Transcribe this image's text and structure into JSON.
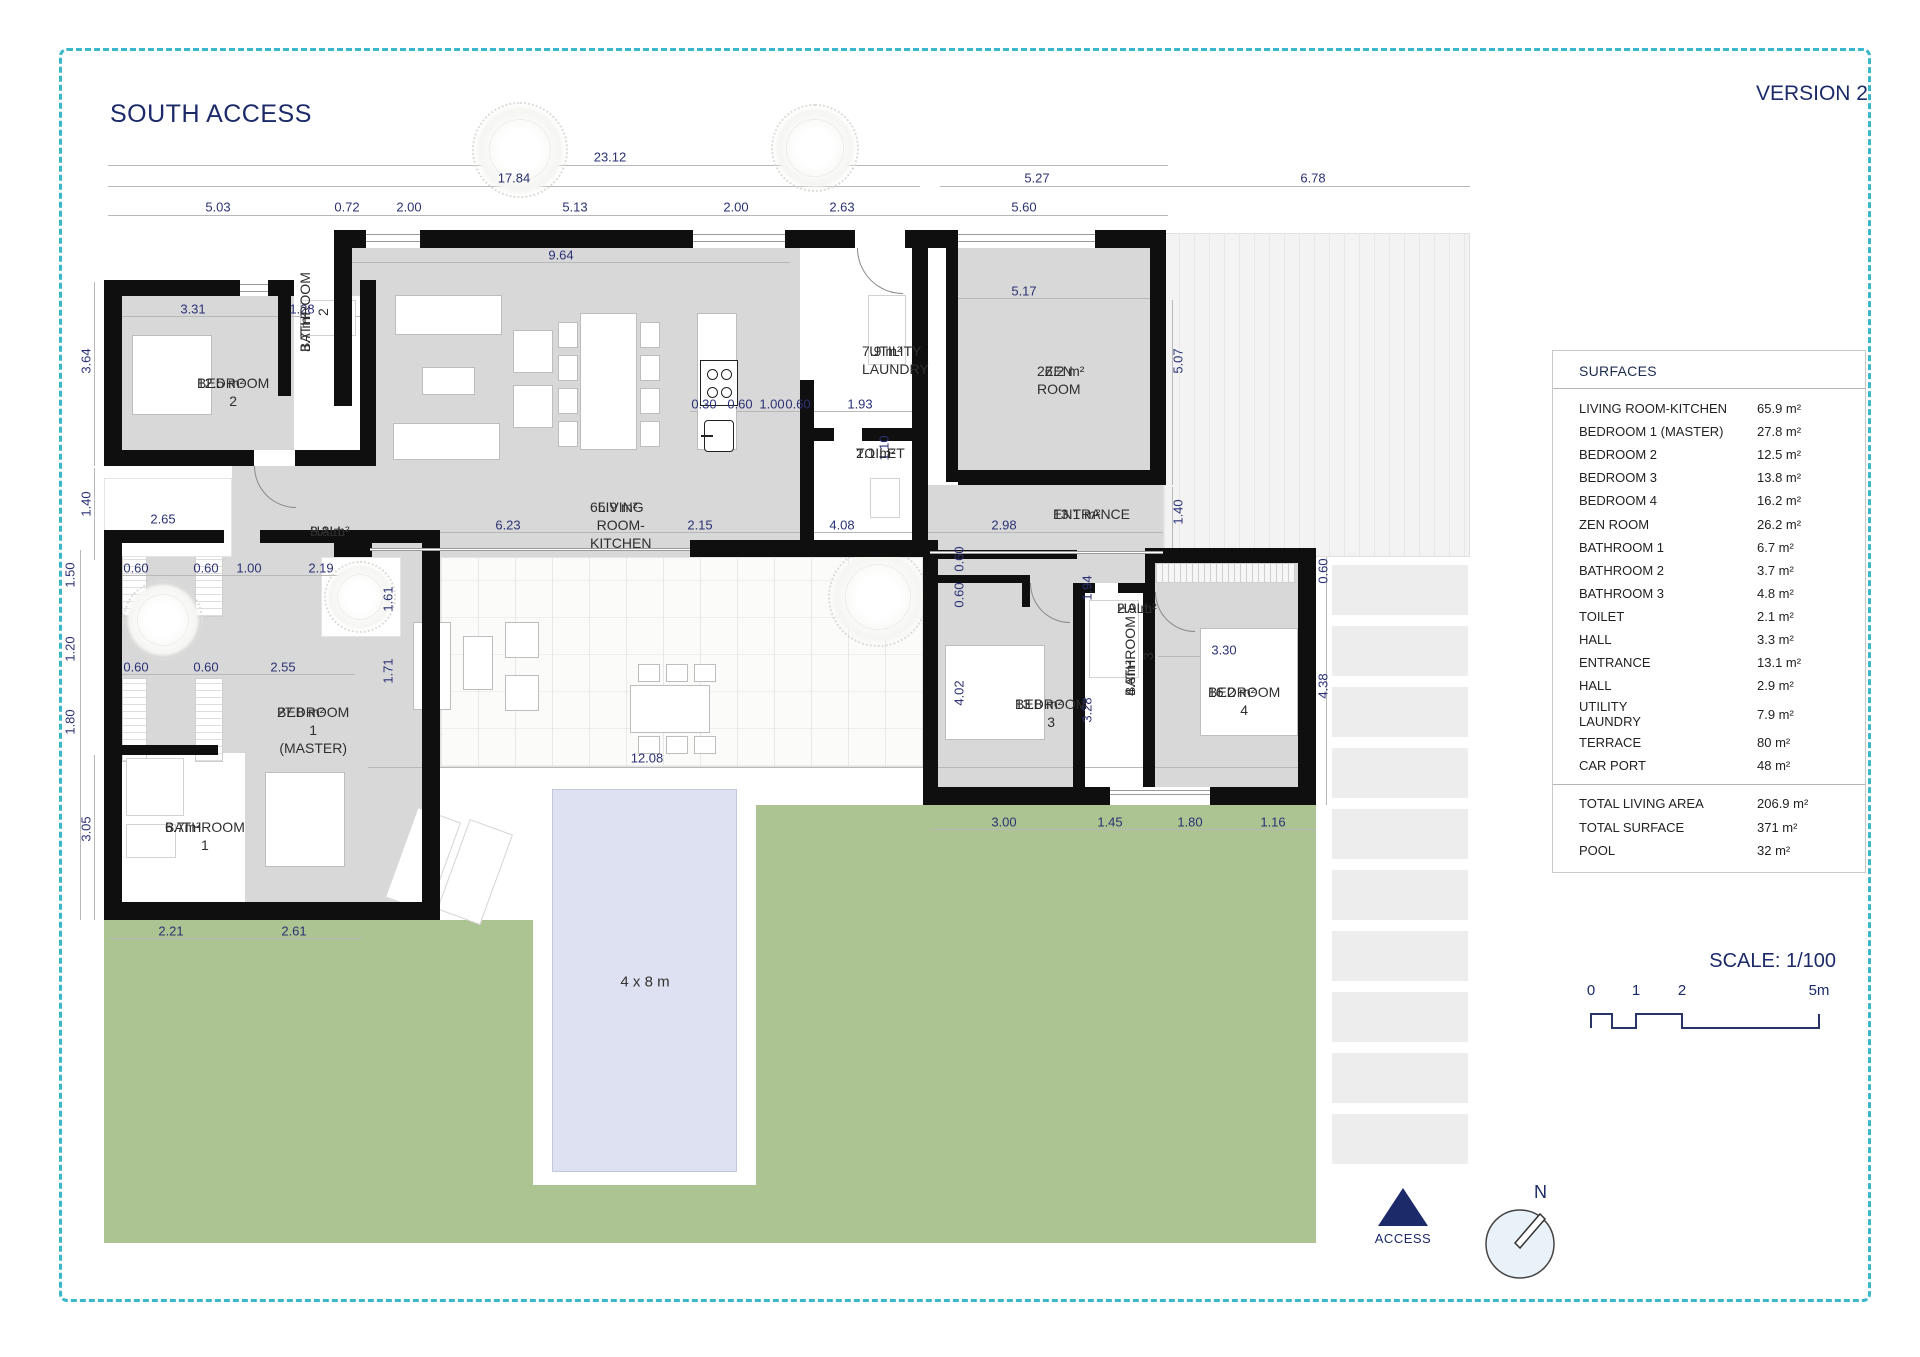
{
  "header": {
    "title": "SOUTH ACCESS",
    "version": "VERSION 2"
  },
  "colors": {
    "accent_navy": "#1c2a6a",
    "border_cyan": "#3ab7ca",
    "grass_green": "#acc392",
    "pool_blue": "#dde1f1",
    "room_gray": "#d8d8d8",
    "wall_black": "#0f0f0f"
  },
  "surfaces_table": {
    "header": "SURFACES",
    "rows": [
      {
        "label": "LIVING ROOM-KITCHEN",
        "value": "65.9 m²"
      },
      {
        "label": "BEDROOM 1 (MASTER)",
        "value": "27.8 m²"
      },
      {
        "label": "BEDROOM 2",
        "value": "12.5 m²"
      },
      {
        "label": "BEDROOM 3",
        "value": "13.8 m²"
      },
      {
        "label": "BEDROOM 4",
        "value": "16.2 m²"
      },
      {
        "label": "ZEN ROOM",
        "value": "26.2 m²"
      },
      {
        "label": "BATHROOM 1",
        "value": "6.7 m²"
      },
      {
        "label": "BATHROOM 2",
        "value": "3.7 m²"
      },
      {
        "label": "BATHROOM 3",
        "value": "4.8 m²"
      },
      {
        "label": "TOILET",
        "value": "2.1 m²"
      },
      {
        "label": "HALL",
        "value": "3.3 m²"
      },
      {
        "label": "ENTRANCE",
        "value": "13.1 m²"
      },
      {
        "label": "HALL",
        "value": "2.9 m²"
      },
      {
        "label": "UTILITY\nLAUNDRY",
        "value": "7.9 m²"
      },
      {
        "label": "TERRACE",
        "value": "80 m²"
      },
      {
        "label": "CAR PORT",
        "value": "48 m²"
      }
    ],
    "totals": [
      {
        "label": "TOTAL LIVING AREA",
        "value": "206.9 m²"
      },
      {
        "label": "TOTAL SURFACE",
        "value": "371 m²"
      },
      {
        "label": "POOL",
        "value": "32 m²"
      }
    ]
  },
  "scale": {
    "label": "SCALE: 1/100",
    "ticks": [
      {
        "t": "0",
        "x": 1
      },
      {
        "t": "1",
        "x": 46
      },
      {
        "t": "2",
        "x": 92
      },
      {
        "t": "5m",
        "x": 229
      }
    ]
  },
  "access": {
    "label": "ACCESS"
  },
  "compass": {
    "label": "N"
  },
  "plan": {
    "pool_label": "4 x 8 m",
    "rooms": [
      {
        "name": "BEDROOM 2",
        "area": "12.5 m²",
        "x": 197,
        "y": 374
      },
      {
        "name": "BATHROOM 2",
        "area": "3.7 m²",
        "x": 296,
        "y": 352,
        "rot": 1
      },
      {
        "name": "HALL",
        "area": "3.3 m²",
        "x": 310,
        "y": 522
      },
      {
        "name": "LIVING ROOM-KITCHEN",
        "area": "65.9 m²",
        "x": 590,
        "y": 498
      },
      {
        "name": "UTILITY\nLAUNDRY",
        "area": "7.9 m²",
        "x": 862,
        "y": 342
      },
      {
        "name": "TOILET",
        "area": "2.1 m²",
        "x": 856,
        "y": 444
      },
      {
        "name": "ZEN ROOM",
        "area": "26.2 m²",
        "x": 1037,
        "y": 362
      },
      {
        "name": "ENTRANCE",
        "area": "13.1 m²",
        "x": 1053,
        "y": 505
      },
      {
        "name": "BEDROOM 1\n(MASTER)",
        "area": "27.8 m²",
        "x": 277,
        "y": 703
      },
      {
        "name": "BATHROOM 1",
        "area": "6.7m²",
        "x": 165,
        "y": 818
      },
      {
        "name": "BEDROOM 3",
        "area": "13.8 m²",
        "x": 1015,
        "y": 695
      },
      {
        "name": "HALL",
        "area": "2.9 m²",
        "x": 1117,
        "y": 599
      },
      {
        "name": "BATHROOM 3",
        "area": "4.8m²",
        "x": 1121,
        "y": 696,
        "rot": 1
      },
      {
        "name": "BEDROOM 4",
        "area": "16.2 m²",
        "x": 1208,
        "y": 683
      }
    ],
    "dimensions": [
      {
        "t": "23.12",
        "x": 610,
        "y": 157
      },
      {
        "t": "17.84",
        "x": 514,
        "y": 178
      },
      {
        "t": "5.03",
        "x": 218,
        "y": 207
      },
      {
        "t": "0.72",
        "x": 347,
        "y": 207
      },
      {
        "t": "2.00",
        "x": 409,
        "y": 207
      },
      {
        "t": "5.13",
        "x": 575,
        "y": 207
      },
      {
        "t": "2.00",
        "x": 736,
        "y": 207
      },
      {
        "t": "2.63",
        "x": 842,
        "y": 207
      },
      {
        "t": "5.60",
        "x": 1024,
        "y": 207
      },
      {
        "t": "5.27",
        "x": 1037,
        "y": 178
      },
      {
        "t": "6.78",
        "x": 1313,
        "y": 178
      },
      {
        "t": "9.64",
        "x": 561,
        "y": 255
      },
      {
        "t": "5.17",
        "x": 1024,
        "y": 291
      },
      {
        "t": "3.31",
        "x": 193,
        "y": 309
      },
      {
        "t": "1.28",
        "x": 302,
        "y": 309
      },
      {
        "t": "5.07",
        "x": 1178,
        "y": 361,
        "r": 1
      },
      {
        "t": "3.64",
        "x": 86,
        "y": 361,
        "r": 1
      },
      {
        "t": "1.40",
        "x": 86,
        "y": 504,
        "r": 1
      },
      {
        "t": "2.65",
        "x": 163,
        "y": 519
      },
      {
        "t": "0.30",
        "x": 704,
        "y": 404
      },
      {
        "t": "0.60",
        "x": 740,
        "y": 404
      },
      {
        "t": "1.00",
        "x": 772,
        "y": 404
      },
      {
        "t": "0.60",
        "x": 798,
        "y": 404
      },
      {
        "t": "1.93",
        "x": 860,
        "y": 404
      },
      {
        "t": "1.10",
        "x": 884,
        "y": 448,
        "r": 1
      },
      {
        "t": "6.23",
        "x": 508,
        "y": 525
      },
      {
        "t": "2.15",
        "x": 700,
        "y": 525
      },
      {
        "t": "4.08",
        "x": 842,
        "y": 525
      },
      {
        "t": "2.98",
        "x": 1004,
        "y": 525
      },
      {
        "t": "1.40",
        "x": 1178,
        "y": 512,
        "r": 1
      },
      {
        "t": "1.50",
        "x": 70,
        "y": 575,
        "r": 1
      },
      {
        "t": "1.20",
        "x": 70,
        "y": 649,
        "r": 1
      },
      {
        "t": "1.80",
        "x": 70,
        "y": 722,
        "r": 1
      },
      {
        "t": "3.05",
        "x": 86,
        "y": 829,
        "r": 1
      },
      {
        "t": "0.60",
        "x": 136,
        "y": 568
      },
      {
        "t": "0.60",
        "x": 206,
        "y": 568
      },
      {
        "t": "1.00",
        "x": 249,
        "y": 568
      },
      {
        "t": "2.19",
        "x": 321,
        "y": 568
      },
      {
        "t": "0.60",
        "x": 136,
        "y": 667
      },
      {
        "t": "0.60",
        "x": 206,
        "y": 667
      },
      {
        "t": "2.55",
        "x": 283,
        "y": 667
      },
      {
        "t": "1.61",
        "x": 388,
        "y": 599,
        "r": 1
      },
      {
        "t": "1.71",
        "x": 388,
        "y": 671,
        "r": 1
      },
      {
        "t": "2.21",
        "x": 171,
        "y": 931
      },
      {
        "t": "2.61",
        "x": 294,
        "y": 931
      },
      {
        "t": "12.08",
        "x": 647,
        "y": 758
      },
      {
        "t": "0.60",
        "x": 959,
        "y": 559,
        "r": 1
      },
      {
        "t": "0.60",
        "x": 959,
        "y": 595,
        "r": 1
      },
      {
        "t": "1.94",
        "x": 1087,
        "y": 588,
        "r": 1
      },
      {
        "t": "4.02",
        "x": 959,
        "y": 693,
        "r": 1
      },
      {
        "t": "3.28",
        "x": 1087,
        "y": 710,
        "r": 1
      },
      {
        "t": "3.30",
        "x": 1224,
        "y": 650
      },
      {
        "t": "4.38",
        "x": 1323,
        "y": 686,
        "r": 1
      },
      {
        "t": "0.60",
        "x": 1323,
        "y": 571,
        "r": 1
      },
      {
        "t": "3.00",
        "x": 1004,
        "y": 822
      },
      {
        "t": "1.45",
        "x": 1110,
        "y": 822
      },
      {
        "t": "1.80",
        "x": 1190,
        "y": 822
      },
      {
        "t": "1.16",
        "x": 1273,
        "y": 822
      }
    ]
  }
}
